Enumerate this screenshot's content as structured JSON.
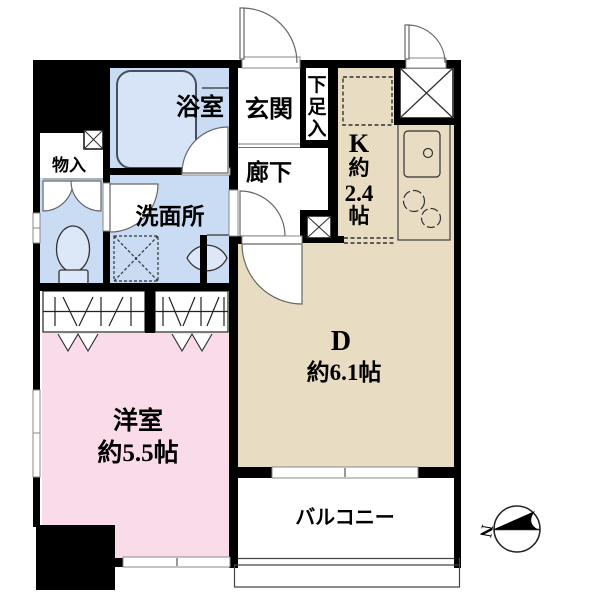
{
  "plan_title": "1DK floor plan",
  "colors": {
    "wall": "#000000",
    "wet_area": "#c9dcf3",
    "bathtub": "#d7e4f7",
    "kitchen_dining": "#e8dcc2",
    "western_room": "#f9dbe9",
    "line_gray": "#555555"
  },
  "rooms": {
    "entrance": {
      "label": "玄関"
    },
    "shoe_storage": {
      "label": "下足入",
      "chars": [
        "下",
        "足",
        "入"
      ]
    },
    "hallway": {
      "label": "廊下"
    },
    "bathroom": {
      "label": "浴室"
    },
    "storage": {
      "label": "物入"
    },
    "washroom": {
      "label": "洗面所"
    },
    "kitchen": {
      "label": "K 約2.4帖",
      "lines": [
        "K",
        "約",
        "2.4",
        "帖"
      ]
    },
    "dining": {
      "letter": "D",
      "size": "約6.1帖"
    },
    "western_room": {
      "label": "洋室",
      "size": "約5.5帖"
    },
    "balcony": {
      "label": "バルコニー"
    }
  },
  "compass": {
    "label": "N",
    "direction": "north-pointing-left"
  }
}
